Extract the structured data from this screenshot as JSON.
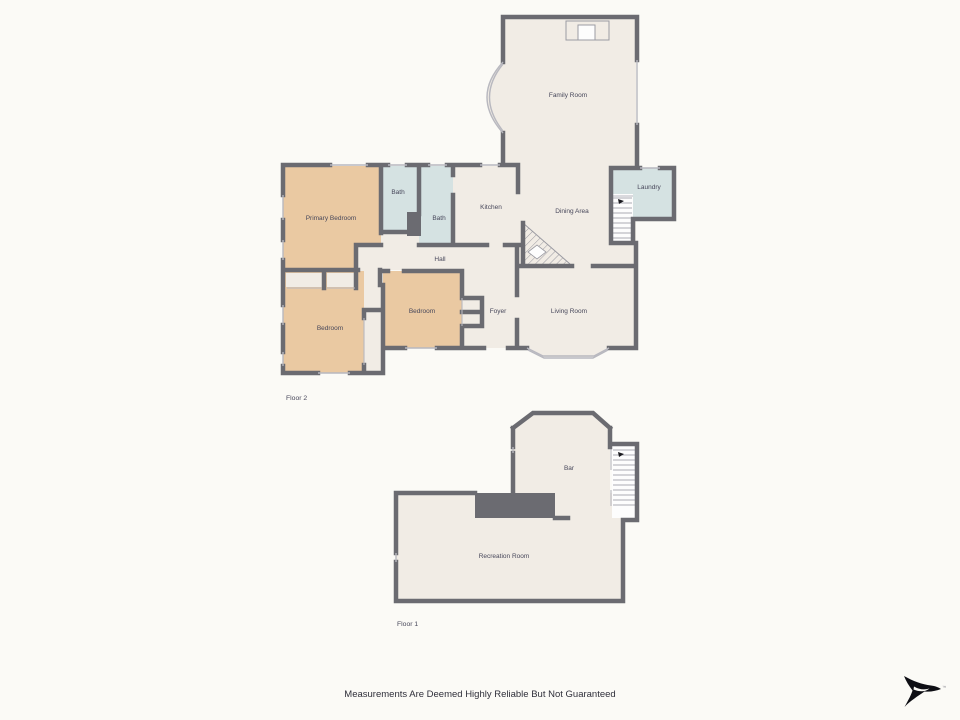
{
  "colors": {
    "bg": "#fbfaf6",
    "wall": "#6b6b71",
    "room": "#f1ece5",
    "bedroom": "#eac9a2",
    "bath": "#d5e2e2",
    "stairs": "#fdfdfd",
    "window": "#b8b8bf",
    "tread": "#abacb2",
    "hatch": "#9b9ba2",
    "label": "#47475a",
    "footer_text": "#2f2f3a",
    "logo": "#0e0e14"
  },
  "floors": [
    {
      "id": "floor-2",
      "label": "Floor 2",
      "rooms": [
        {
          "id": "family-room",
          "label": "Family Room"
        },
        {
          "id": "laundry",
          "label": "Laundry"
        },
        {
          "id": "kitchen",
          "label": "Kitchen"
        },
        {
          "id": "dining-area",
          "label": "Dining Area"
        },
        {
          "id": "bath-1",
          "label": "Bath"
        },
        {
          "id": "bath-2",
          "label": "Bath"
        },
        {
          "id": "primary-bedroom",
          "label": "Primary Bedroom"
        },
        {
          "id": "hall",
          "label": "Hall"
        },
        {
          "id": "bedroom-left",
          "label": "Bedroom"
        },
        {
          "id": "bedroom-middle",
          "label": "Bedroom"
        },
        {
          "id": "foyer",
          "label": "Foyer"
        },
        {
          "id": "living-room",
          "label": "Living Room"
        }
      ]
    },
    {
      "id": "floor-1",
      "label": "Floor 1",
      "rooms": [
        {
          "id": "bar",
          "label": "Bar"
        },
        {
          "id": "recreation-room",
          "label": "Recreation Room"
        }
      ]
    }
  ],
  "footer": {
    "disclaimer": "Measurements Are Deemed Highly Reliable But Not Guaranteed"
  },
  "logo": {
    "trademark": "™"
  }
}
